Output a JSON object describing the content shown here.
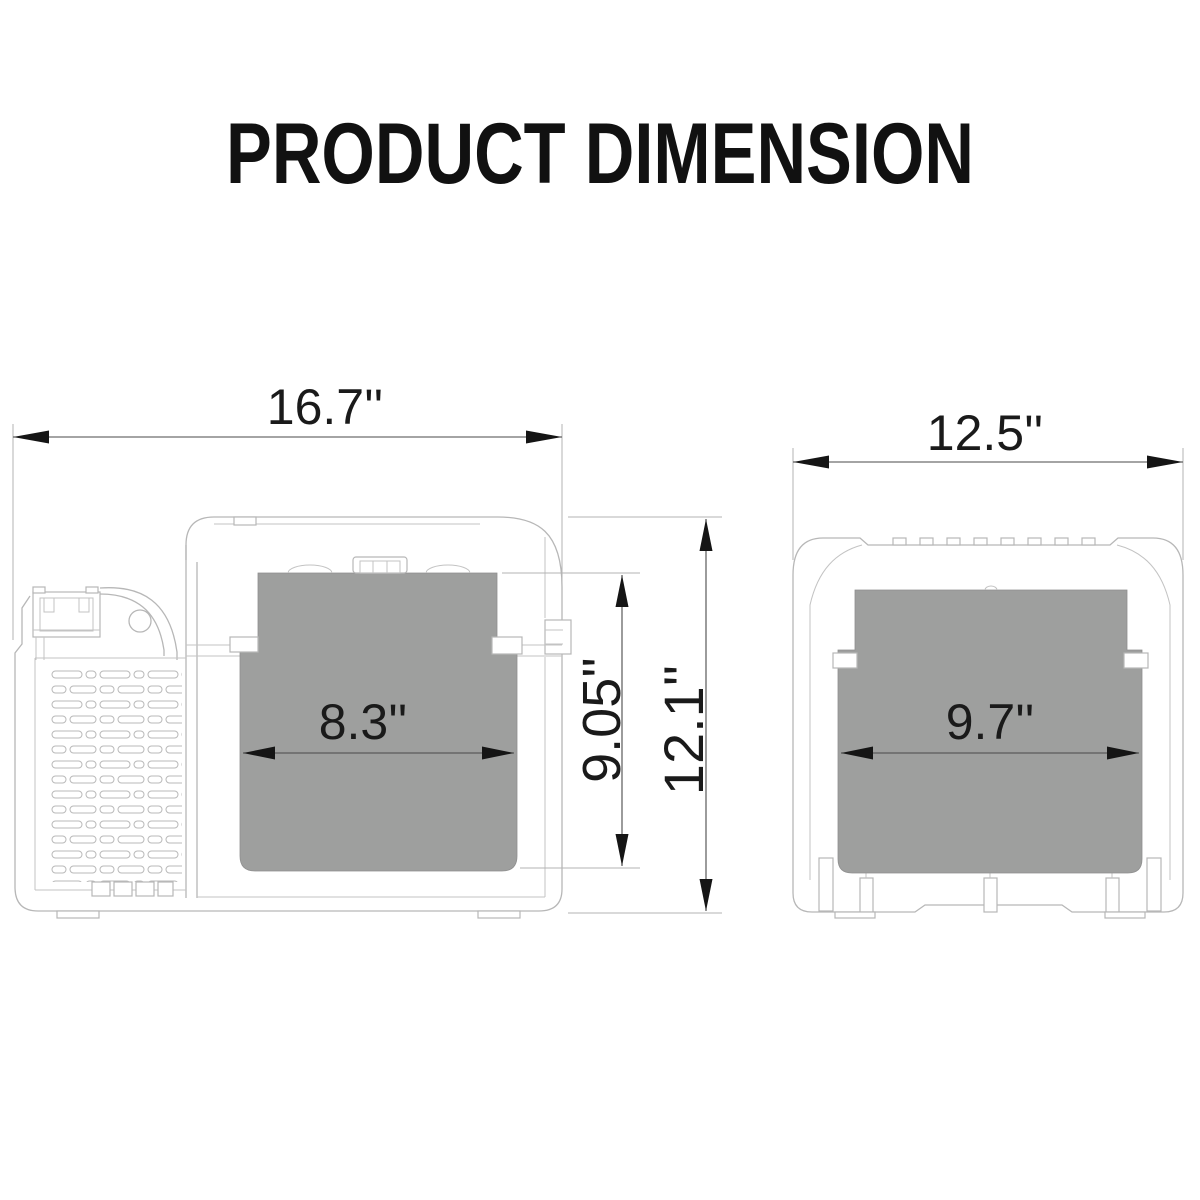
{
  "title": "PRODUCT DIMENSION",
  "side_view": {
    "overall_width": "16.7''",
    "opening_width": "8.3''",
    "compartment_depth": "9.05''",
    "overall_height": "12.1''"
  },
  "front_view": {
    "overall_width": "12.5''",
    "opening_width": "9.7''"
  },
  "colors": {
    "interior_fill": "#9e9f9e",
    "outline": "#b7b7b7",
    "dimension_ink": "#1a1a1a"
  }
}
